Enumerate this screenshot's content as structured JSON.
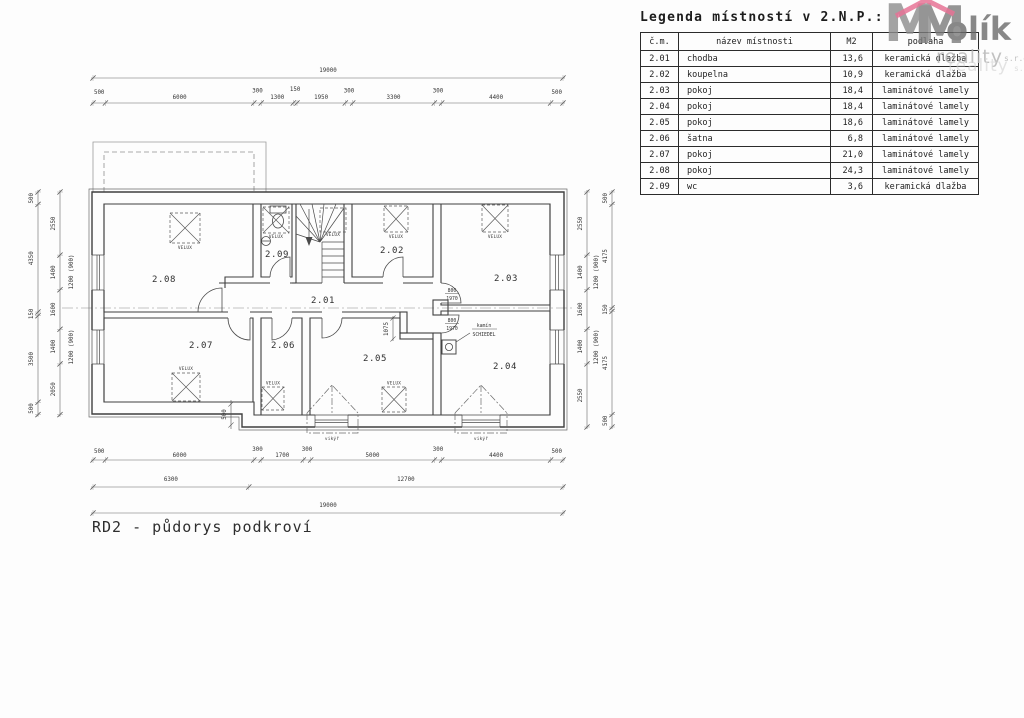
{
  "drawing_title": "RD2 - půdorys podkroví",
  "legend": {
    "title": "Legenda místností v 2.N.P.:",
    "headers": [
      "č.m.",
      "název místnosti",
      "M2",
      "podlaha"
    ],
    "rows": [
      [
        "2.01",
        "chodba",
        "13,6",
        "keramická dlažba"
      ],
      [
        "2.02",
        "koupelna",
        "10,9",
        "keramická dlažba"
      ],
      [
        "2.03",
        "pokoj",
        "18,4",
        "laminátové lamely"
      ],
      [
        "2.04",
        "pokoj",
        "18,4",
        "laminátové lamely"
      ],
      [
        "2.05",
        "pokoj",
        "18,6",
        "laminátové lamely"
      ],
      [
        "2.06",
        "šatna",
        "6,8",
        "laminátové lamely"
      ],
      [
        "2.07",
        "pokoj",
        "21,0",
        "laminátové lamely"
      ],
      [
        "2.08",
        "pokoj",
        "24,3",
        "laminátové lamely"
      ],
      [
        "2.09",
        "wc",
        "3,6",
        "keramická dlažba"
      ]
    ]
  },
  "watermark": {
    "m1": "M",
    "m2": "M",
    "olik": "olík",
    "reality": "reality",
    "sro": "s.r.o.",
    "reality2": "reality",
    "sro2": "s.r.o."
  },
  "rooms": {
    "r201": "2.01",
    "r202": "2.02",
    "r203": "2.03",
    "r204": "2.04",
    "r205": "2.05",
    "r206": "2.06",
    "r207": "2.07",
    "r208": "2.08",
    "r209": "2.09"
  },
  "labels": {
    "velux": "VELUX",
    "vikyr": "vikýř",
    "kamin": "kamín",
    "schiedel": "SCHIEDEL",
    "door_w": "800",
    "door_h": "1970",
    "jog_dim": "1075",
    "step_dim": "500",
    "window_note": "1200 (900)"
  },
  "dims": {
    "top_total": "19000",
    "top": [
      "500",
      "6000",
      "300",
      "1300",
      "150",
      "1950",
      "300",
      "3300",
      "300",
      "4400",
      "500"
    ],
    "bottom": [
      "500",
      "6000",
      "300",
      "1700",
      "300",
      "5000",
      "300",
      "4400",
      "500"
    ],
    "bottom_mid": [
      "6300",
      "12700"
    ],
    "bottom_total": "19000",
    "left_outer": [
      "500",
      "4350",
      "150",
      "3500",
      "500"
    ],
    "left_inner": [
      "2550",
      "1400",
      "1600",
      "1400",
      "2050"
    ],
    "right_inner": [
      "2550",
      "1400",
      "1600",
      "1400",
      "2550"
    ],
    "right_outer": [
      "500",
      "4175",
      "150",
      "4175",
      "500"
    ]
  },
  "colors": {
    "line": "#3f3f3f",
    "dim": "#666666",
    "text": "#333333",
    "accent_pink": "#e2517d",
    "watermark_gray": "#8d8d8d"
  }
}
